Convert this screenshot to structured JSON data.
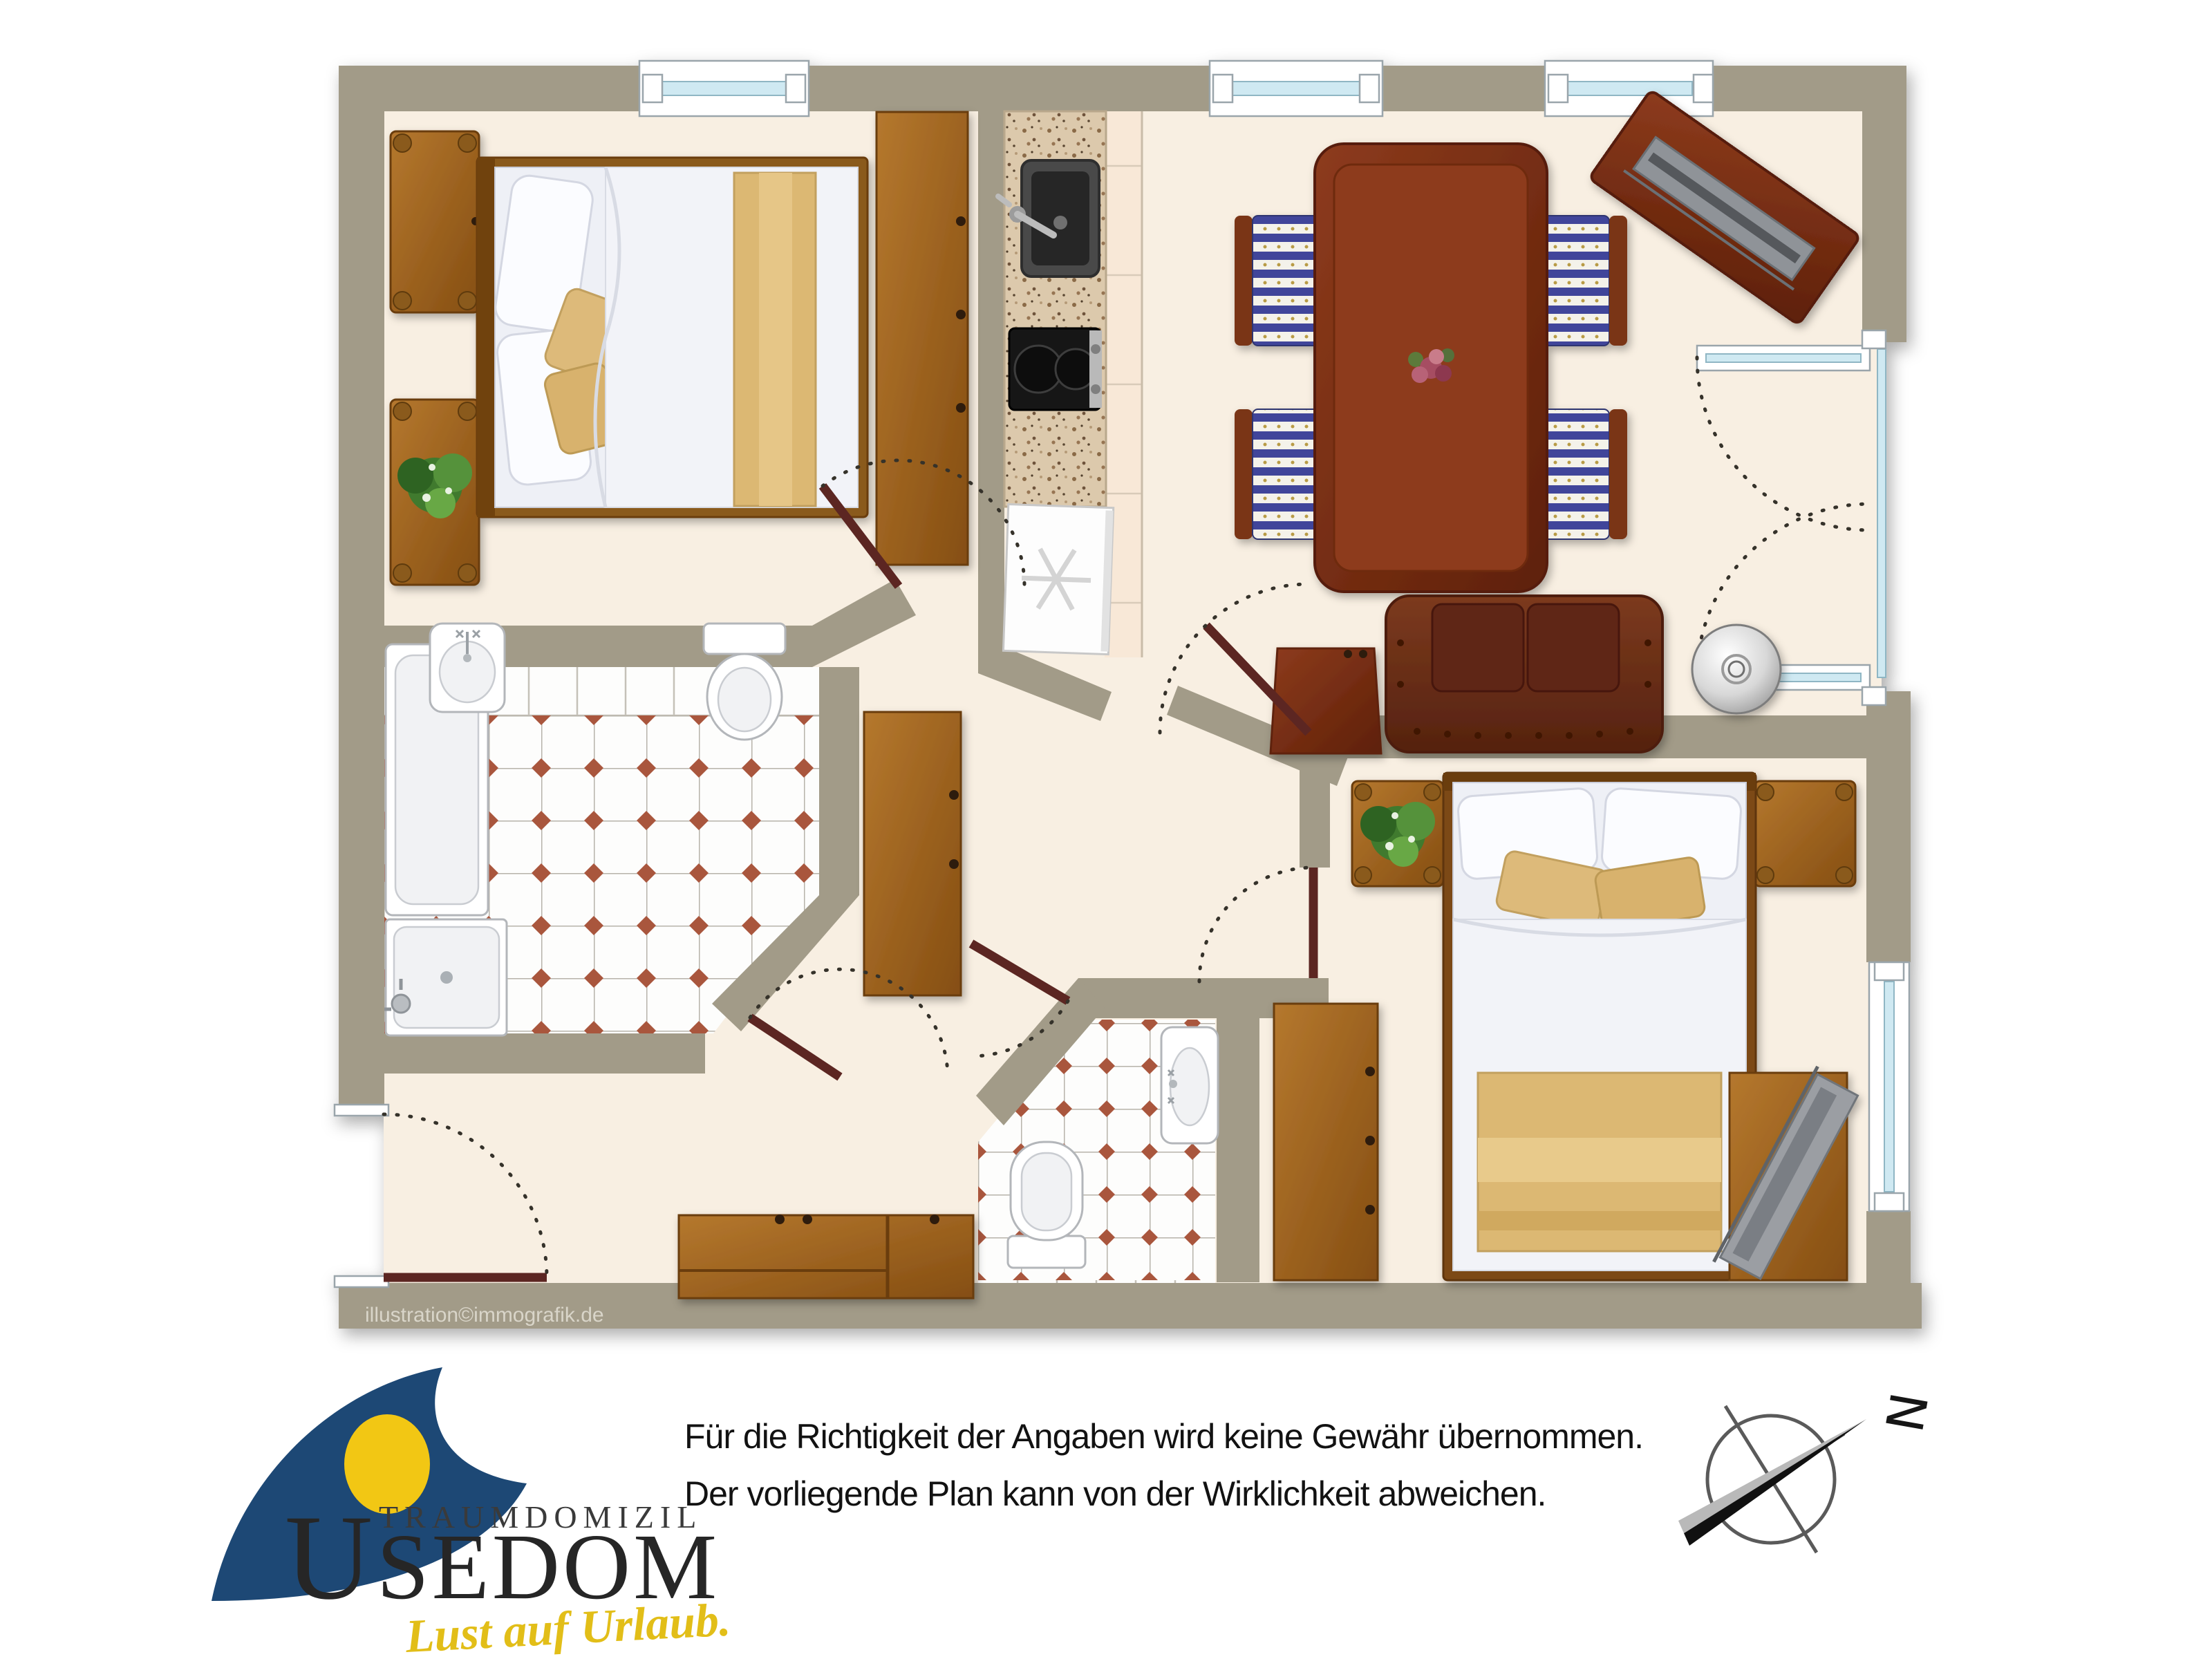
{
  "plan": {
    "watermark": "illustration©immografik.de",
    "colors": {
      "wall": "#a29b88",
      "floor": "#f8efe2",
      "tile_accent": "#a9573e",
      "door_leaf": "#5c2723",
      "window_glass": "#cfe9f2",
      "wood_oak": "#9a6120",
      "wood_dark": "#7c321a",
      "sofa_leather": "#6e3018"
    }
  },
  "footer": {
    "disclaimer_line1": "Für die Richtigkeit der Angaben wird keine Gewähr übernommen.",
    "disclaimer_line2": "Der vorliegende Plan kann von der Wirklichkeit abweichen.",
    "logo": {
      "brand_small": "TRAUMDOMIZIL",
      "brand_initial": "U",
      "brand_rest": "SEDOM",
      "tagline": "Lust auf Urlaub.",
      "mark_color": "#1d4875",
      "mark_dot_color": "#f2c714",
      "tagline_color": "#e2be18"
    },
    "compass": {
      "north_label": "N"
    }
  }
}
